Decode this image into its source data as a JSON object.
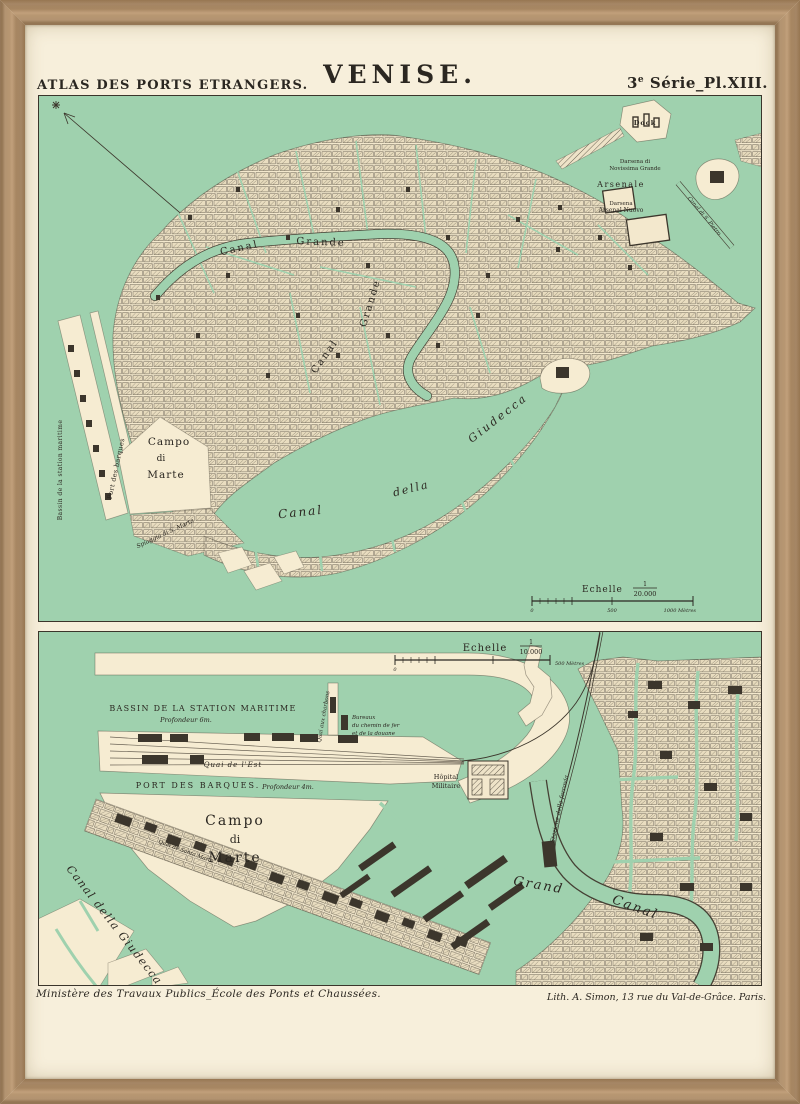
{
  "colors": {
    "frame_wood": "#b3906a",
    "paper": "#f7efdb",
    "water": "#9fd1ae",
    "land": "#f6ecd2",
    "ink": "#2b2721"
  },
  "header": {
    "atlas": "ATLAS DES PORTS ETRANGERS.",
    "title": "VENISE.",
    "plate_prefix": "3",
    "plate_sup": "e",
    "plate_rest": " Série_Pl.XIII."
  },
  "top_map": {
    "labels": {
      "canal_1": "Canal",
      "grande_1": "Grande",
      "canal_2": "Canal",
      "grande_2": "Grande",
      "canal_della": "Canal",
      "della": "della",
      "giudecca": "Giudecca",
      "campo": "Campo",
      "di": "di",
      "marte": "Marte",
      "bassin_station": "Bassin de la station maritime",
      "port_barques": "Port des barques",
      "spiaggia": "Spiaggia di S. Marta",
      "arsenale": "Arsenale",
      "darsena_line1": "Darsena di",
      "darsena_line2": "Novissima Grande",
      "darsena_nuovo_line1": "Darsena",
      "darsena_nuovo_line2": "Arsenal Nuovo",
      "dock": "Dock",
      "canal_s_pietro": "Canal di S. Pietro"
    },
    "scale": {
      "word": "Echelle",
      "num": "1",
      "den": "20.000",
      "tick_zero": "0",
      "tick_mid": "500",
      "tick_end": "1000 Mètres"
    }
  },
  "bottom_map": {
    "labels": {
      "bassin": "BASSIN DE LA STATION MARITIME",
      "prof6": "Profondeur 6m.",
      "quai_est": "Quai de l'Est",
      "quai_charbons": "Quai aux charbons",
      "bureaux_1": "Bureaux",
      "bureaux_2": "du chemin de fer",
      "bureaux_3": "et de la douane",
      "port_barques": "PORT DES BARQUES.",
      "prof4": "Profondeur 4m.",
      "campo": "Campo",
      "di": "di",
      "marte": "Marte",
      "canal_della_giudecca": "Canal della Giudecca",
      "quai_santa_marta": "Quai de Santa Marta",
      "hopital_1": "Hôpital",
      "hopital_2": "Militaire",
      "stazione": "Stazione della ferrovia",
      "grand": "Grand",
      "canal": "Canal"
    },
    "scale": {
      "word": "Echelle",
      "num": "1",
      "den": "10.000",
      "tick_zero": "0",
      "tick_end": "500 Mètres"
    }
  },
  "footer": {
    "left": "Ministère des Travaux Publics_École des Ponts et Chaussées.",
    "right": "Lith. A. Simon, 13 rue du Val-de-Grâce. Paris."
  }
}
